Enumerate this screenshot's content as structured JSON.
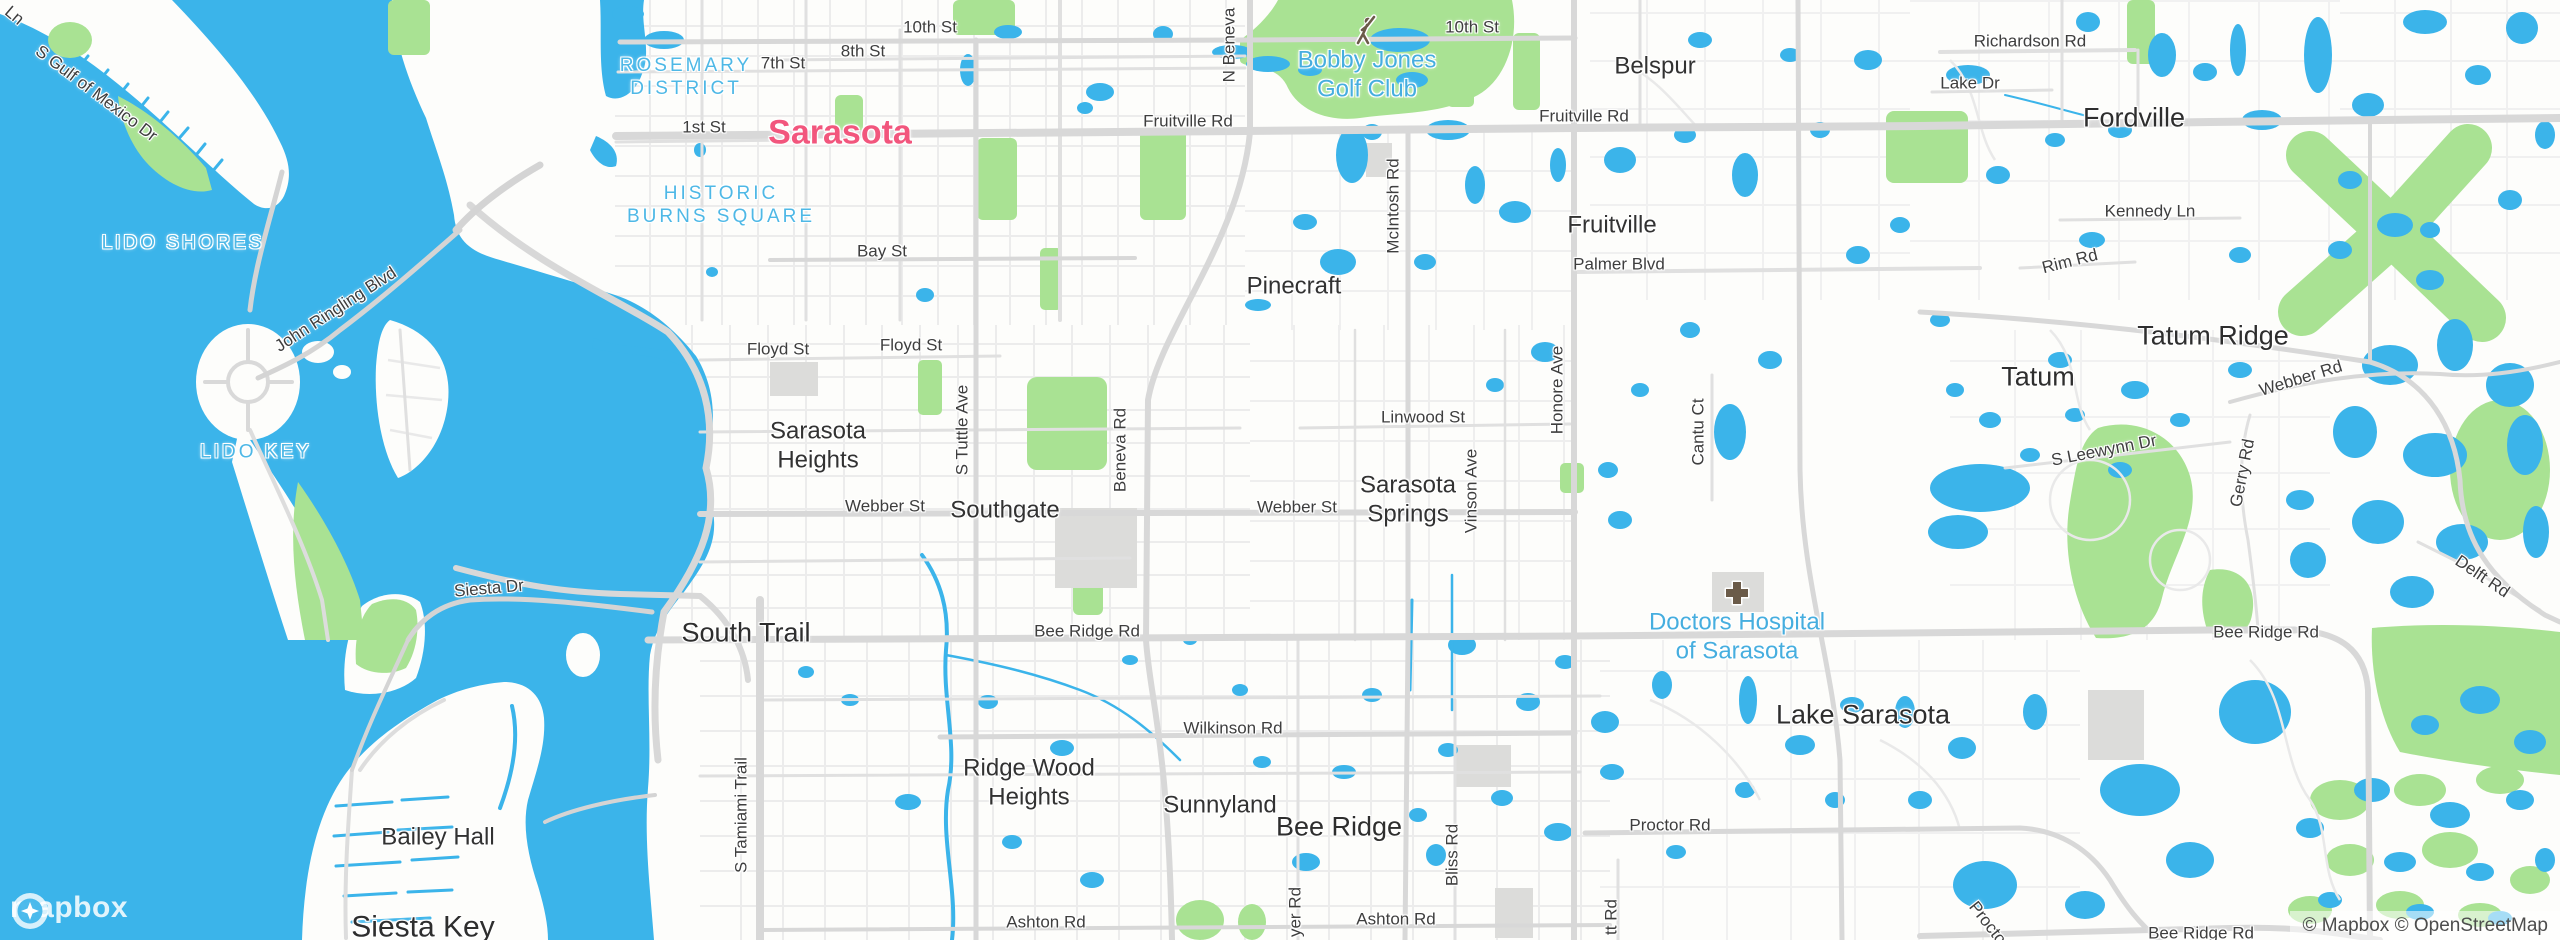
{
  "map": {
    "colors": {
      "water": "#3BB4EA",
      "park": "#A9E293",
      "land": "#FDFDFB",
      "road_major": "#D8D8D8",
      "road_minor": "#ECECEC",
      "building": "#DCDCDA",
      "city_label": "#F2567D",
      "area_label": "#4EB8E6",
      "poi_label": "#46AEDF",
      "road_label": "#3E3E3E"
    },
    "labels": [
      {
        "id": "ln-fragment",
        "text": "Ln",
        "x": 14,
        "y": 16,
        "t": "road",
        "r": 40
      },
      {
        "id": "s-gulf-of-mexico-dr",
        "text": "S Gulf of Mexico Dr",
        "x": 96,
        "y": 94,
        "t": "road",
        "r": 37
      },
      {
        "id": "john-ringling-blvd",
        "text": "John Ringling Blvd",
        "x": 336,
        "y": 310,
        "t": "road",
        "r": -33
      },
      {
        "id": "tenth-st-w",
        "text": "10th St",
        "x": 930,
        "y": 28,
        "t": "road"
      },
      {
        "id": "eighth-st",
        "text": "8th St",
        "x": 863,
        "y": 52,
        "t": "road"
      },
      {
        "id": "seventh-st",
        "text": "7th St",
        "x": 783,
        "y": 64,
        "t": "road"
      },
      {
        "id": "first-st",
        "text": "1st St",
        "x": 704,
        "y": 128,
        "t": "road"
      },
      {
        "id": "fruitville-rd-w",
        "text": "Fruitville Rd",
        "x": 1188,
        "y": 122,
        "t": "road"
      },
      {
        "id": "tenth-st-e",
        "text": "10th St",
        "x": 1472,
        "y": 28,
        "t": "road"
      },
      {
        "id": "fruitville-rd-e",
        "text": "Fruitville Rd",
        "x": 1584,
        "y": 117,
        "t": "road"
      },
      {
        "id": "bay-st",
        "text": "Bay St",
        "x": 882,
        "y": 252,
        "t": "road"
      },
      {
        "id": "floyd-st-w",
        "text": "Floyd St",
        "x": 778,
        "y": 350,
        "t": "road"
      },
      {
        "id": "floyd-st-e",
        "text": "Floyd St",
        "x": 911,
        "y": 346,
        "t": "road"
      },
      {
        "id": "webber-st-w",
        "text": "Webber St",
        "x": 885,
        "y": 507,
        "t": "road"
      },
      {
        "id": "webber-st-e",
        "text": "Webber St",
        "x": 1297,
        "y": 508,
        "t": "road"
      },
      {
        "id": "linwood-st",
        "text": "Linwood St",
        "x": 1423,
        "y": 418,
        "t": "road"
      },
      {
        "id": "bee-ridge-rd-w",
        "text": "Bee Ridge Rd",
        "x": 1087,
        "y": 632,
        "t": "road"
      },
      {
        "id": "wilkinson-rd",
        "text": "Wilkinson Rd",
        "x": 1233,
        "y": 729,
        "t": "road"
      },
      {
        "id": "ashton-rd-w",
        "text": "Ashton Rd",
        "x": 1046,
        "y": 923,
        "t": "road"
      },
      {
        "id": "ashton-rd-e",
        "text": "Ashton Rd",
        "x": 1396,
        "y": 920,
        "t": "road"
      },
      {
        "id": "proctor-rd",
        "text": "Proctor Rd",
        "x": 1670,
        "y": 826,
        "t": "road"
      },
      {
        "id": "siesta-dr",
        "text": "Siesta Dr",
        "x": 489,
        "y": 589,
        "t": "road",
        "r": -5
      },
      {
        "id": "palmer-blvd",
        "text": "Palmer Blvd",
        "x": 1619,
        "y": 265,
        "t": "road"
      },
      {
        "id": "kennedy-ln",
        "text": "Kennedy Ln",
        "x": 2150,
        "y": 212,
        "t": "road"
      },
      {
        "id": "richardson-rd",
        "text": "Richardson Rd",
        "x": 2030,
        "y": 42,
        "t": "road"
      },
      {
        "id": "lake-dr",
        "text": "Lake Dr",
        "x": 1970,
        "y": 84,
        "t": "road"
      },
      {
        "id": "rim-rd",
        "text": "Rim Rd",
        "x": 2070,
        "y": 262,
        "t": "road",
        "r": -14
      },
      {
        "id": "webber-rd",
        "text": "Webber Rd",
        "x": 2301,
        "y": 379,
        "t": "road",
        "r": -17
      },
      {
        "id": "s-leewynn-dr",
        "text": "S Leewynn Dr",
        "x": 2104,
        "y": 451,
        "t": "road",
        "r": -11
      },
      {
        "id": "gerry-rd",
        "text": "Gerry Rd",
        "x": 2243,
        "y": 473,
        "t": "road",
        "r": -79
      },
      {
        "id": "delft-rd",
        "text": "Delft Rd",
        "x": 2482,
        "y": 577,
        "t": "road",
        "r": 34
      },
      {
        "id": "bee-ridge-rd-e",
        "text": "Bee Ridge Rd",
        "x": 2266,
        "y": 633,
        "t": "road"
      },
      {
        "id": "bee-ridge-rd-s",
        "text": "Bee Ridge Rd",
        "x": 2201,
        "y": 934,
        "t": "road"
      },
      {
        "id": "proctor-rd-diag",
        "text": "Proctor Rd",
        "x": 1997,
        "y": 936,
        "t": "road",
        "r": 52
      },
      {
        "id": "s-tamiami-trail",
        "text": "S Tamiami Trail",
        "x": 742,
        "y": 815,
        "t": "road",
        "r": -90
      },
      {
        "id": "s-tuttle-ave",
        "text": "S Tuttle Ave",
        "x": 963,
        "y": 430,
        "t": "road",
        "r": -90
      },
      {
        "id": "beneva-rd",
        "text": "Beneva Rd",
        "x": 1121,
        "y": 450,
        "t": "road",
        "r": -90
      },
      {
        "id": "n-beneva",
        "text": "N Beneva",
        "x": 1230,
        "y": 45,
        "t": "road",
        "r": -90
      },
      {
        "id": "mcintosh-rd",
        "text": "McIntosh Rd",
        "x": 1394,
        "y": 206,
        "t": "road",
        "r": -90
      },
      {
        "id": "honore-ave",
        "text": "Honore Ave",
        "x": 1558,
        "y": 390,
        "t": "road",
        "r": -90
      },
      {
        "id": "vinson-ave",
        "text": "Vinson Ave",
        "x": 1472,
        "y": 491,
        "t": "road",
        "r": -90
      },
      {
        "id": "cantu-ct",
        "text": "Cantu Ct",
        "x": 1699,
        "y": 432,
        "t": "road",
        "r": -90
      },
      {
        "id": "bliss-rd",
        "text": "Bliss Rd",
        "x": 1453,
        "y": 855,
        "t": "road",
        "r": -90
      },
      {
        "id": "yer-rd-fragment",
        "text": "yer Rd",
        "x": 1296,
        "y": 912,
        "t": "road",
        "r": -90
      },
      {
        "id": "tt-rd-fragment",
        "text": "tt Rd",
        "x": 1612,
        "y": 917,
        "t": "road",
        "r": -90
      },
      {
        "id": "sarasota-city",
        "text": "Sarasota",
        "x": 840,
        "y": 133,
        "t": "city"
      },
      {
        "id": "rosemary-district",
        "text": "ROSEMARY\nDISTRICT",
        "x": 686,
        "y": 77,
        "t": "area"
      },
      {
        "id": "historic-burns-square",
        "text": "HISTORIC\nBURNS SQUARE",
        "x": 721,
        "y": 205,
        "t": "area"
      },
      {
        "id": "lido-shores",
        "text": "LIDO SHORES",
        "x": 183,
        "y": 243,
        "t": "area"
      },
      {
        "id": "lido-key",
        "text": "LIDO KEY",
        "x": 256,
        "y": 452,
        "t": "area"
      },
      {
        "id": "bobby-jones-golf-club",
        "text": "Bobby Jones\nGolf Club",
        "x": 1367,
        "y": 75,
        "t": "poi"
      },
      {
        "id": "doctors-hospital-of-sarasota",
        "text": "Doctors Hospital\nof Sarasota",
        "x": 1737,
        "y": 637,
        "t": "poi"
      },
      {
        "id": "pinecraft",
        "text": "Pinecraft",
        "x": 1294,
        "y": 286,
        "t": "town"
      },
      {
        "id": "sarasota-heights",
        "text": "Sarasota\nHeights",
        "x": 818,
        "y": 446,
        "t": "town"
      },
      {
        "id": "southgate",
        "text": "Southgate",
        "x": 1005,
        "y": 510,
        "t": "town"
      },
      {
        "id": "sarasota-springs",
        "text": "Sarasota\nSprings",
        "x": 1408,
        "y": 500,
        "t": "town"
      },
      {
        "id": "fruitville-town",
        "text": "Fruitville",
        "x": 1612,
        "y": 225,
        "t": "town"
      },
      {
        "id": "belspur",
        "text": "Belspur",
        "x": 1655,
        "y": 66,
        "t": "town"
      },
      {
        "id": "fordville",
        "text": "Fordville",
        "x": 2134,
        "y": 118,
        "t": "big"
      },
      {
        "id": "tatum-ridge",
        "text": "Tatum Ridge",
        "x": 2213,
        "y": 336,
        "t": "big"
      },
      {
        "id": "tatum",
        "text": "Tatum",
        "x": 2038,
        "y": 377,
        "t": "big"
      },
      {
        "id": "lake-sarasota",
        "text": "Lake Sarasota",
        "x": 1863,
        "y": 715,
        "t": "big"
      },
      {
        "id": "bee-ridge-town",
        "text": "Bee Ridge",
        "x": 1339,
        "y": 827,
        "t": "big"
      },
      {
        "id": "sunnyland",
        "text": "Sunnyland",
        "x": 1220,
        "y": 805,
        "t": "town"
      },
      {
        "id": "ridge-wood-heights",
        "text": "Ridge Wood\nHeights",
        "x": 1029,
        "y": 783,
        "t": "town"
      },
      {
        "id": "south-trail",
        "text": "South Trail",
        "x": 746,
        "y": 633,
        "t": "big"
      },
      {
        "id": "bailey-hall",
        "text": "Bailey Hall",
        "x": 438,
        "y": 837,
        "t": "town"
      },
      {
        "id": "siesta-key",
        "text": "Siesta Key",
        "x": 423,
        "y": 928,
        "t": "big",
        "s": 30
      }
    ],
    "icons": [
      {
        "id": "golfer-icon",
        "x": 1364,
        "y": 32
      },
      {
        "id": "hospital-icon",
        "x": 1737,
        "y": 593
      }
    ],
    "logo": {
      "text": "mapbox"
    },
    "attribution": {
      "text": "© Mapbox © OpenStreetMap"
    }
  }
}
